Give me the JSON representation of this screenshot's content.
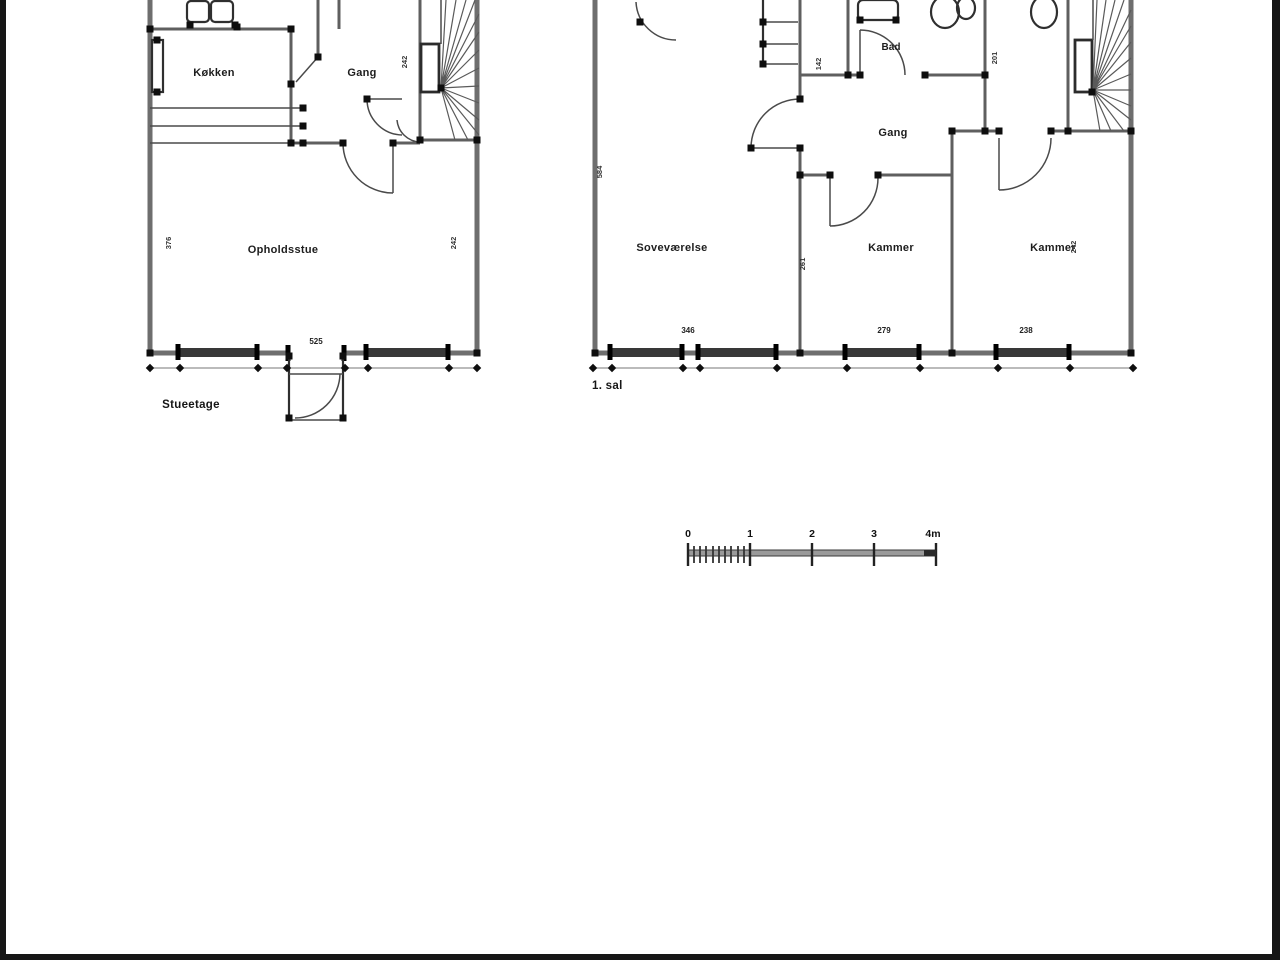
{
  "ground_floor": {
    "floor_label": "Stueetage",
    "rooms": {
      "kitchen": "Køkken",
      "hall": "Gang",
      "living_room": "Opholdsstue"
    },
    "dims": {
      "living_width": "525",
      "left_height": "376",
      "right_height": "242",
      "stair_width": "242"
    }
  },
  "first_floor": {
    "floor_label": "1. sal",
    "rooms": {
      "bedroom": "Soveværelse",
      "bath": "Bad",
      "hall": "Gang",
      "chamber_mid": "Kammer",
      "chamber_right": "Kammer"
    },
    "dims": {
      "left_height": "584",
      "bedroom_width": "346",
      "chamber_mid_width": "279",
      "chamber_right_width": "238",
      "right_height": "242",
      "bath_side": "142",
      "wc_side": "201",
      "wall_mid": "261"
    }
  },
  "scale_bar": {
    "labels": [
      "0",
      "1",
      "2",
      "3",
      "4m"
    ]
  },
  "colors": {
    "background": "#ffffff",
    "wall_line": "#6e6e6e",
    "ink": "#111111",
    "frame": "#161616"
  }
}
